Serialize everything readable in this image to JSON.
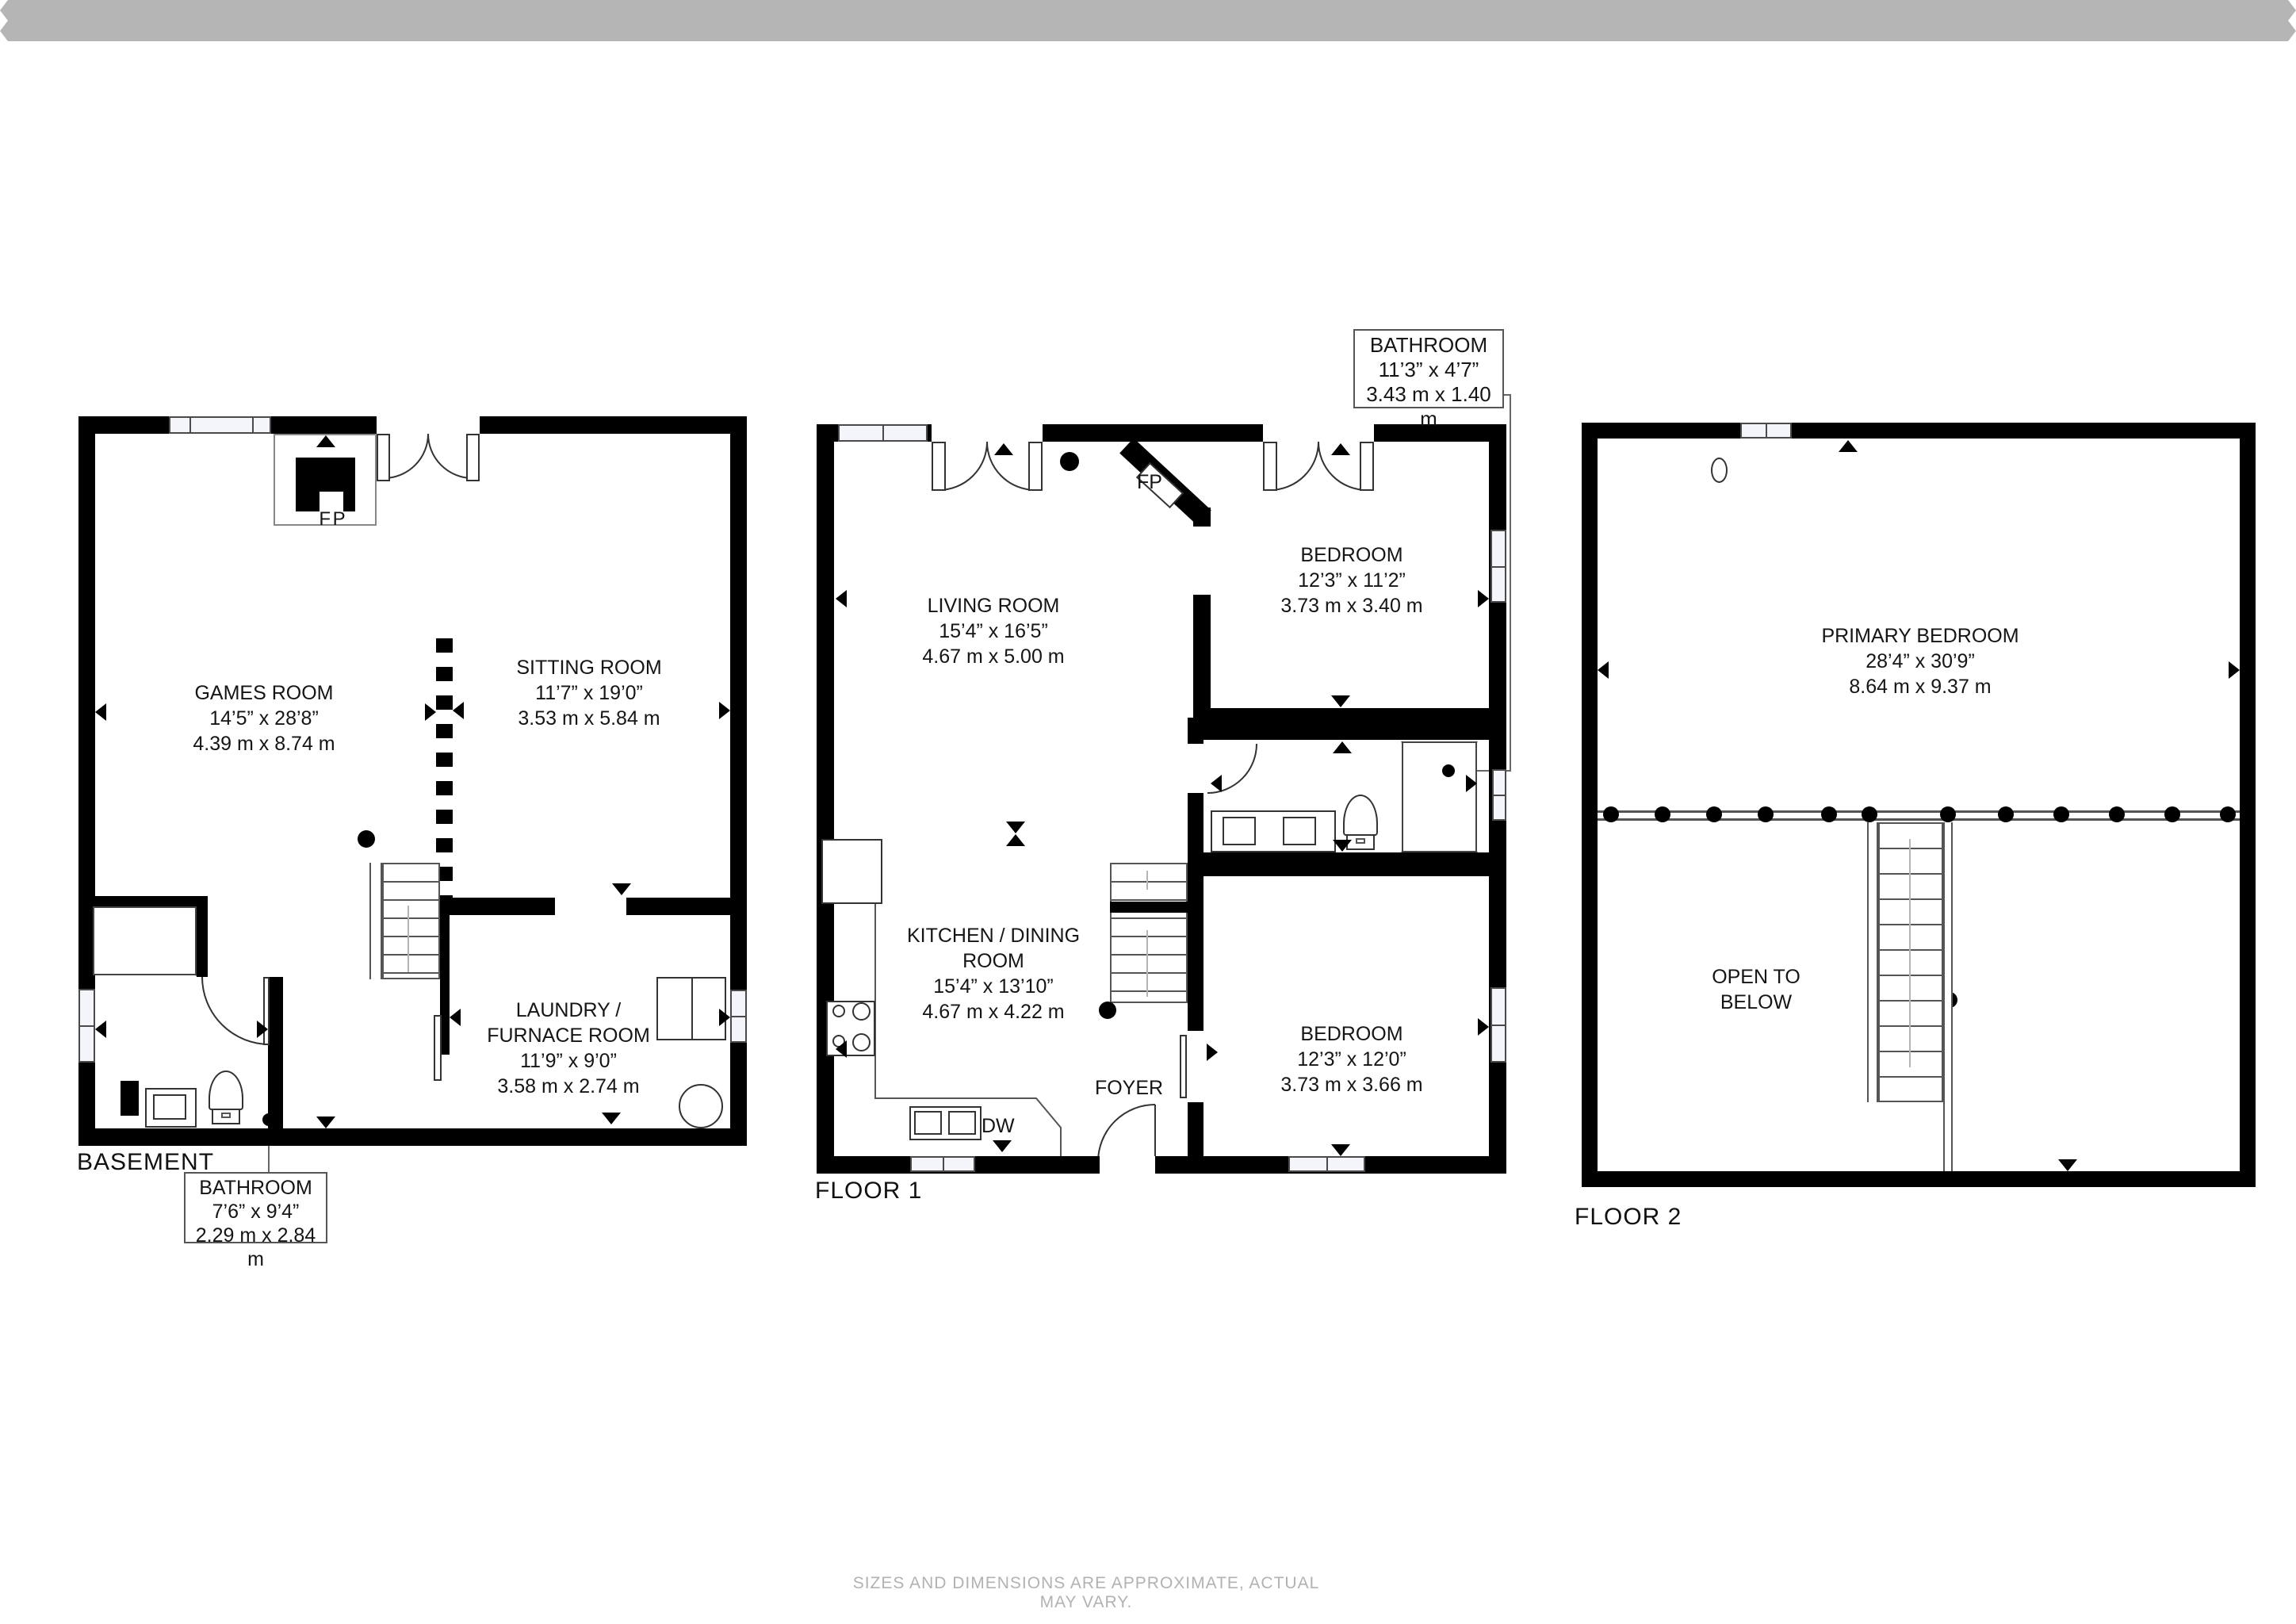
{
  "disclaimer": "SIZES AND DIMENSIONS ARE APPROXIMATE, ACTUAL MAY VARY.",
  "floors": [
    {
      "label": "BASEMENT",
      "fireplace_label": "F P",
      "rooms": [
        {
          "name": "GAMES ROOM",
          "imperial": "14’5” x 28’8”",
          "metric": "4.39 m x 8.74 m"
        },
        {
          "name": "SITTING ROOM",
          "imperial": "11’7” x 19’0”",
          "metric": "3.53 m x 5.84 m"
        },
        {
          "name": "LAUNDRY / FURNACE ROOM",
          "imperial": "11’9” x 9’0”",
          "metric": "3.58 m x 2.74 m"
        }
      ],
      "callout": {
        "name": "BATHROOM",
        "imperial": "7’6” x 9’4”",
        "metric": "2.29 m x 2.84 m"
      }
    },
    {
      "label": "FLOOR 1",
      "fireplace_label": "FP",
      "dishwasher_label": "DW",
      "rooms": [
        {
          "name": "LIVING ROOM",
          "imperial": "15’4” x 16’5”",
          "metric": "4.67 m x 5.00 m"
        },
        {
          "name": "KITCHEN / DINING ROOM",
          "imperial": "15’4” x 13’10”",
          "metric": "4.67 m x 4.22 m"
        },
        {
          "name": "BEDROOM",
          "imperial": "12’3” x 11’2”",
          "metric": "3.73 m x 3.40 m"
        },
        {
          "name": "BEDROOM",
          "imperial": "12’3” x 12’0”",
          "metric": "3.73 m x 3.66 m"
        },
        {
          "name": "FOYER"
        }
      ],
      "callout": {
        "name": "BATHROOM",
        "imperial": "11’3” x 4’7”",
        "metric": "3.43 m x 1.40 m"
      }
    },
    {
      "label": "FLOOR 2",
      "rooms": [
        {
          "name": "PRIMARY BEDROOM",
          "imperial": "28’4” x 30’9”",
          "metric": "8.64 m x 9.37 m"
        },
        {
          "name": "OPEN TO BELOW"
        }
      ]
    }
  ]
}
